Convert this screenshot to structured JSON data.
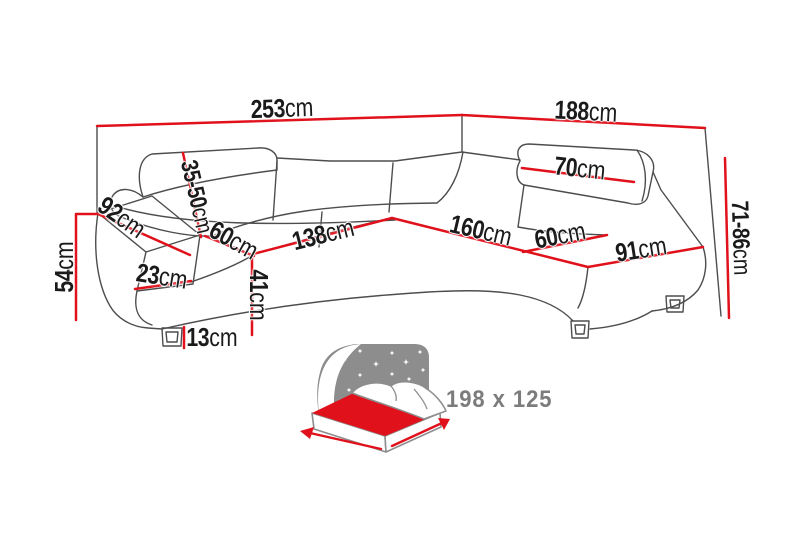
{
  "diagram": {
    "type": "corner-sofa dimension drawing",
    "unit": "cm",
    "dims": {
      "width_total": {
        "value": "253",
        "unit": "cm"
      },
      "depth_total": {
        "value": "188",
        "unit": "cm"
      },
      "arm_depth": {
        "value": "92",
        "unit": "cm"
      },
      "headrest_range": {
        "value": "35-50",
        "unit": "cm"
      },
      "seat_depth_l": {
        "value": "60",
        "unit": "cm"
      },
      "seat_width_l": {
        "value": "138",
        "unit": "cm"
      },
      "chaise_length": {
        "value": "160",
        "unit": "cm"
      },
      "seat_depth_r": {
        "value": "60",
        "unit": "cm"
      },
      "end_width": {
        "value": "91",
        "unit": "cm"
      },
      "headrest_width": {
        "value": "70",
        "unit": "cm"
      },
      "back_height": {
        "value": "71-86",
        "unit": "cm"
      },
      "arm_height": {
        "value": "54",
        "unit": "cm"
      },
      "arm_width": {
        "value": "23",
        "unit": "cm"
      },
      "seat_height": {
        "value": "41",
        "unit": "cm"
      },
      "leg_height": {
        "value": "13",
        "unit": "cm"
      }
    },
    "sleeping_area": {
      "label": "198 x 125"
    }
  },
  "colors": {
    "dimension": "#e1111c",
    "outline": "#4d4d4d",
    "label": "#1a1a1a",
    "icon-gray": "#8d8d8d",
    "bed-text": "#7c7c7c"
  }
}
